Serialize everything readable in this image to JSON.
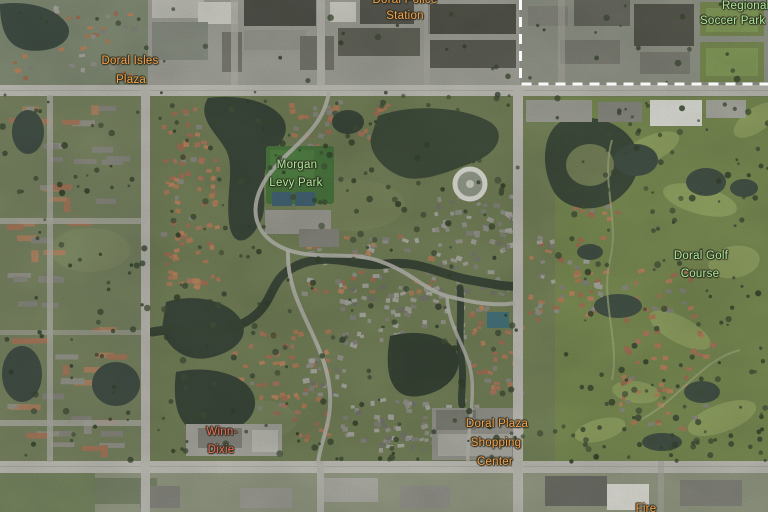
{
  "labels": {
    "police": {
      "line1": "Doral Police",
      "line2": "Station"
    },
    "soccer": {
      "line1": "Regional",
      "line2": "Soccer Park"
    },
    "isles": {
      "line1": "Doral Isles",
      "line2": "Plaza"
    },
    "morgan": {
      "line1": "Morgan",
      "line2": "Levy Park"
    },
    "golf": {
      "line1": "Doral Golf",
      "line2": "Course"
    },
    "winn": {
      "line1": "Winn-",
      "line2": "Dixie"
    },
    "plaza": {
      "line1": "Doral Plaza",
      "line2": "Shopping",
      "line3": "Center"
    },
    "partial_bottom": {
      "line1": "Fire"
    }
  },
  "colors": {
    "poi_label": "#f5a24b",
    "park_label": "#a9e998",
    "store_label": "#ee6f58",
    "boundary_line": "#ffffff"
  }
}
